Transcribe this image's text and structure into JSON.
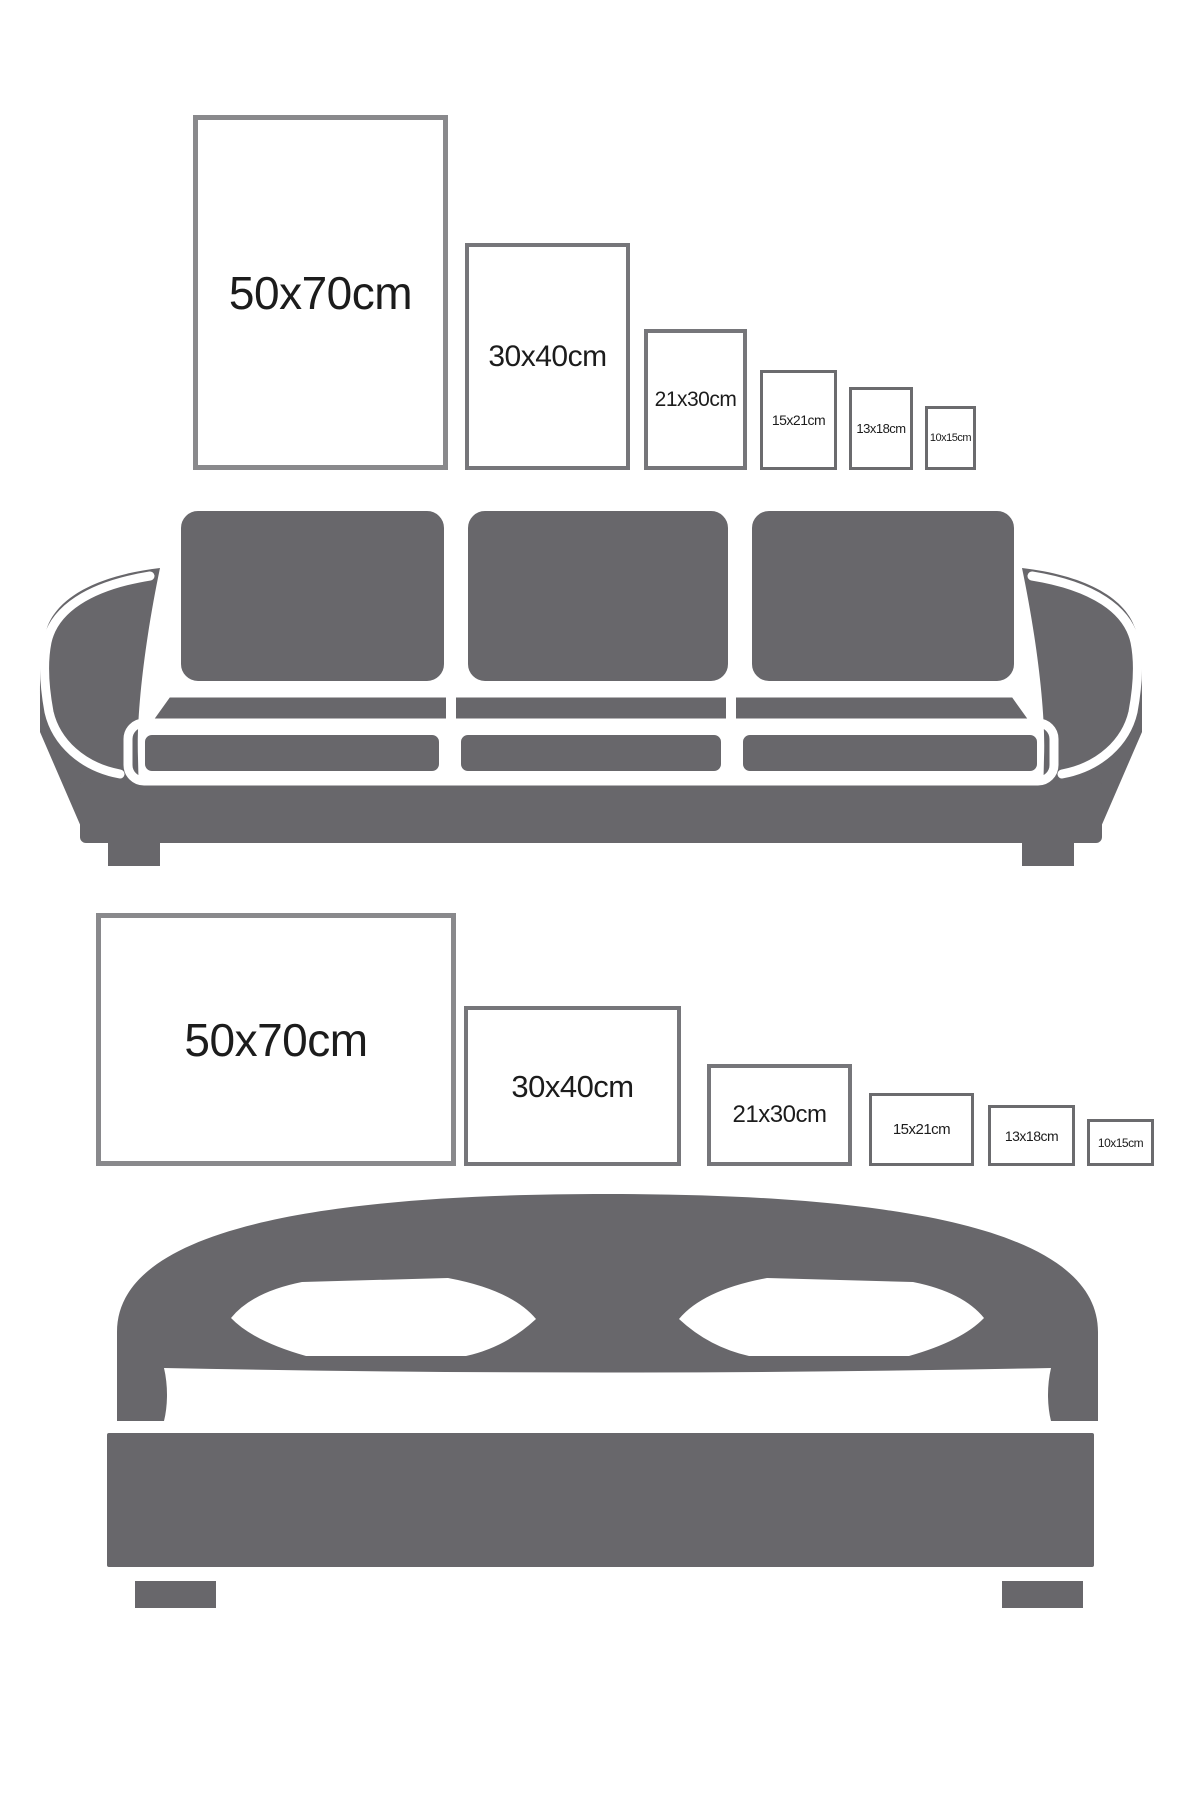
{
  "colors": {
    "background": "#ffffff",
    "furniture": "#68676b",
    "frame_border_large": "#89898c",
    "frame_border_medium": "#76767a",
    "frame_border_small": "#6b6b6e",
    "label_text": "#1c1c1c"
  },
  "size_guide": {
    "sofa_section": {
      "furniture_icon": "sofa-icon",
      "frame_orientation": "portrait",
      "frames": [
        {
          "label": "50x70cm"
        },
        {
          "label": "30x40cm"
        },
        {
          "label": "21x30cm"
        },
        {
          "label": "15x21cm"
        },
        {
          "label": "13x18cm"
        },
        {
          "label": "10x15cm"
        }
      ]
    },
    "bed_section": {
      "furniture_icon": "bed-icon",
      "frame_orientation": "landscape",
      "frames": [
        {
          "label": "50x70cm"
        },
        {
          "label": "30x40cm"
        },
        {
          "label": "21x30cm"
        },
        {
          "label": "15x21cm"
        },
        {
          "label": "13x18cm"
        },
        {
          "label": "10x15cm"
        }
      ]
    }
  }
}
